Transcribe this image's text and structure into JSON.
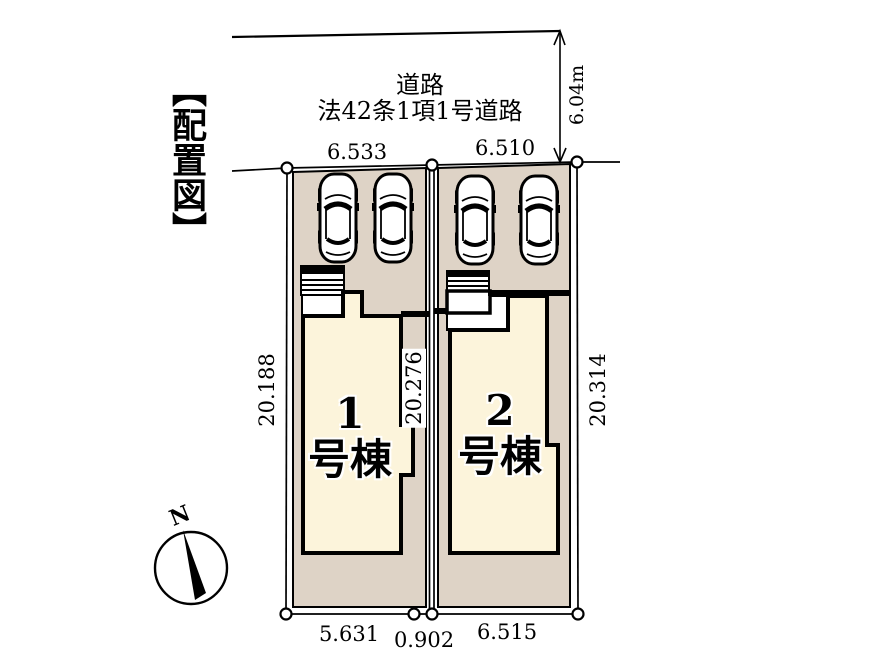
{
  "title": "【配置図】",
  "road": {
    "name": "道路",
    "type": "法42条1項1号道路",
    "width": "6.04m"
  },
  "dimensions": {
    "lot1_top": "6.533",
    "lot2_top": "6.510",
    "lot1_left": "20.188",
    "lot1_right": "20.276",
    "lot2_right": "20.314",
    "lot1_bottom": "5.631",
    "gap_bottom": "0.902",
    "lot2_bottom": "6.515"
  },
  "buildings": [
    {
      "number": "1",
      "suffix": "号棟"
    },
    {
      "number": "2",
      "suffix": "号棟"
    }
  ],
  "compass": {
    "north": "N"
  },
  "colors": {
    "lot_fill": "#ded3c6",
    "building_fill": "#fcf4db",
    "line": "#000000"
  }
}
